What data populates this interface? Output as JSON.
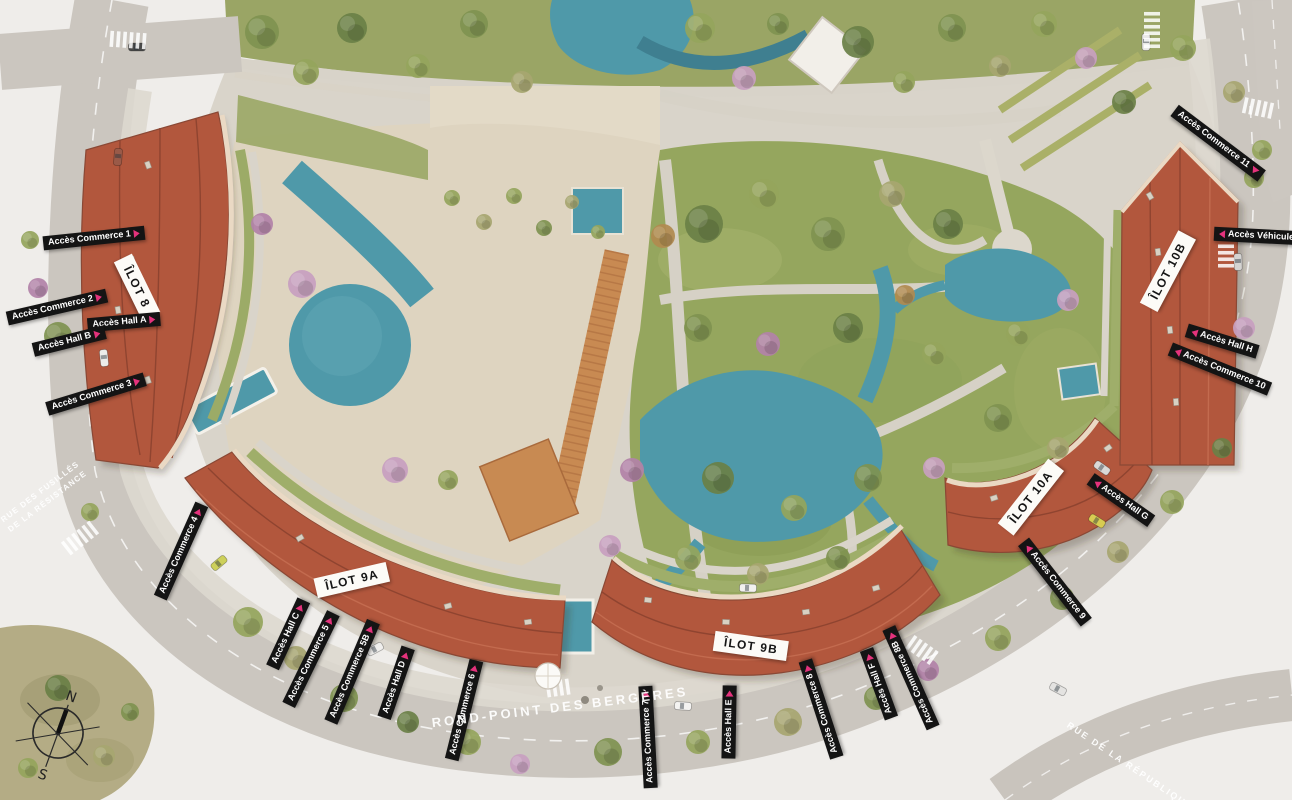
{
  "plan": {
    "ilots": [
      {
        "name": "ÎLOT 8"
      },
      {
        "name": "ÎLOT 9A"
      },
      {
        "name": "ÎLOT 9B"
      },
      {
        "name": "ÎLOT 10A"
      },
      {
        "name": "ÎLOT 10B"
      }
    ],
    "access_points": [
      {
        "label": "Accès Commerce 1"
      },
      {
        "label": "Accès Hall A"
      },
      {
        "label": "Accès Commerce 2"
      },
      {
        "label": "Accès Hall B"
      },
      {
        "label": "Accès Commerce 3"
      },
      {
        "label": "Accès Commerce 4"
      },
      {
        "label": "Accès Hall C"
      },
      {
        "label": "Accès Commerce 5"
      },
      {
        "label": "Accès Commerce 5B"
      },
      {
        "label": "Accès Hall D"
      },
      {
        "label": "Accès Commerce 6"
      },
      {
        "label": "Accès Commerce 7"
      },
      {
        "label": "Accès Hall E"
      },
      {
        "label": "Accès Commerce 8"
      },
      {
        "label": "Accès Hall F"
      },
      {
        "label": "Accès Commerce 8B"
      },
      {
        "label": "Accès Commerce 9"
      },
      {
        "label": "Accès Hall G"
      },
      {
        "label": "Accès Commerce 10"
      },
      {
        "label": "Accès Hall H"
      },
      {
        "label": "Accès Véhicules"
      },
      {
        "label": "Accès Commerce 11"
      }
    ],
    "streets": [
      {
        "line1": "RUE DES FUSILLÉS",
        "line2": "DE LA RÉSISTANCE"
      },
      {
        "name": "ROND-POINT DES BERGÈRES"
      },
      {
        "name": "RUE DE LA RÉPUBLIQUE"
      }
    ],
    "compass": {
      "north": "N",
      "south": "S"
    },
    "colors": {
      "roof": "#b2573d",
      "water": "#4f99a9",
      "grass": "#94a55d",
      "plaza": "#ddd3c0",
      "road": "#cbc6bf",
      "label_bg": "#141414",
      "label_text": "#ffffff",
      "arrow_pink": "#e4327c"
    }
  }
}
